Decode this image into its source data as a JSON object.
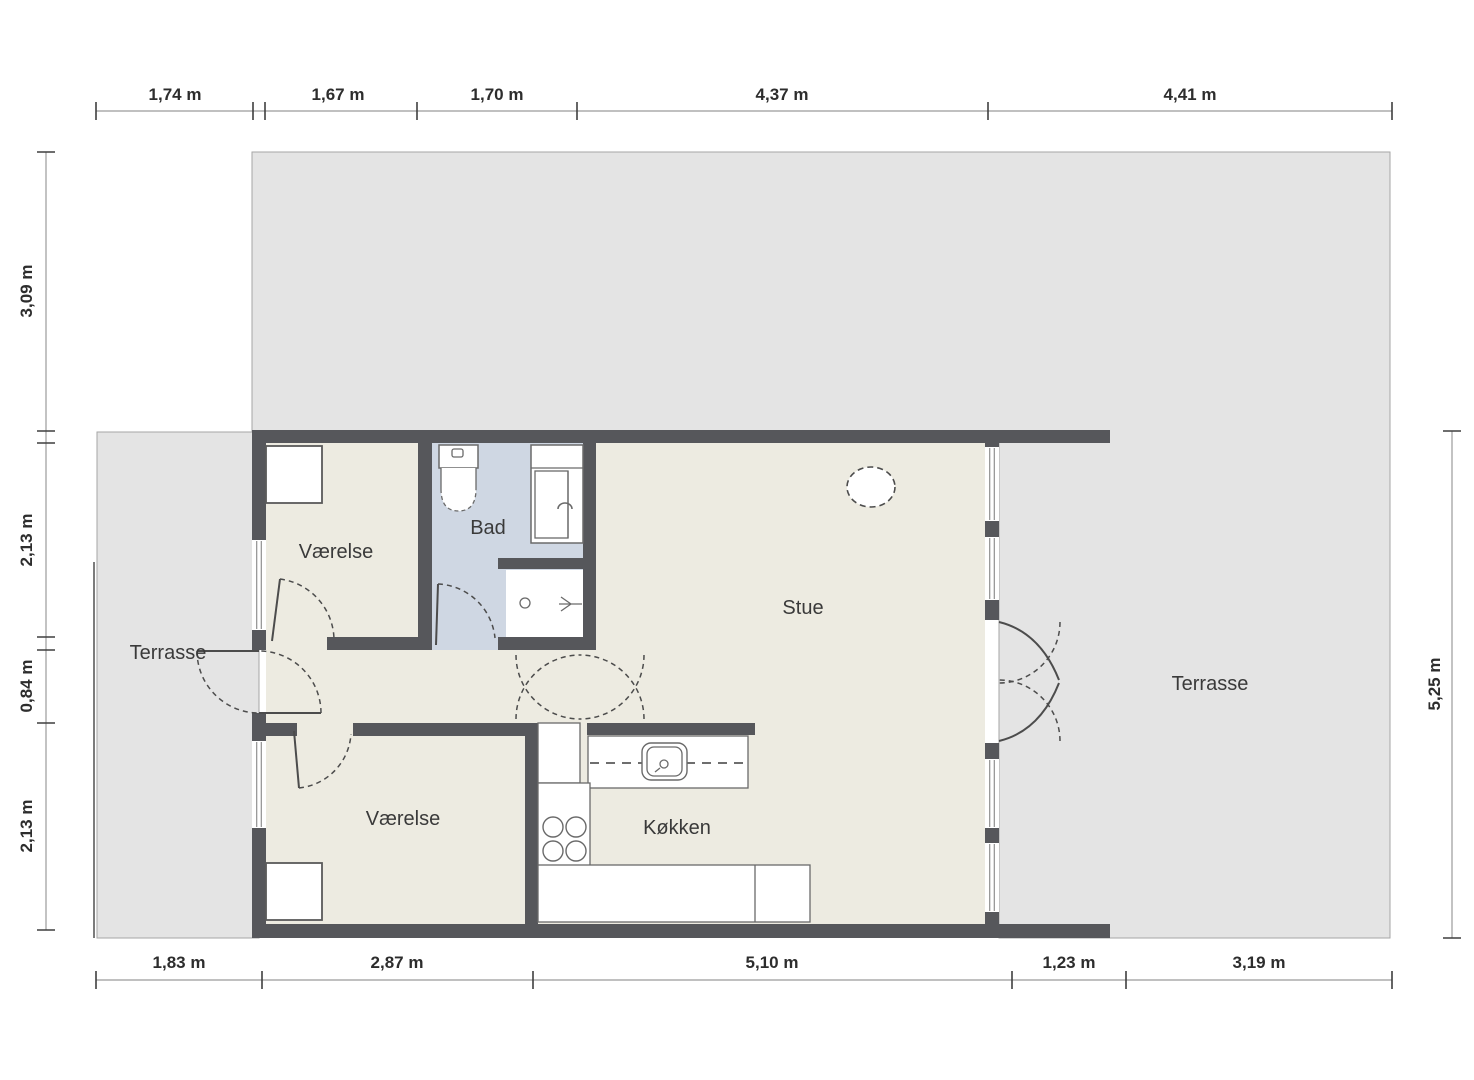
{
  "plan": {
    "rooms": {
      "terrasse_left": "Terrasse",
      "vaerelse_top": "Værelse",
      "bad": "Bad",
      "stue": "Stue",
      "vaerelse_bottom": "Værelse",
      "koekken": "Køkken",
      "terrasse_right": "Terrasse"
    },
    "dimensions": {
      "top": [
        "1,74 m",
        "1,67 m",
        "1,70 m",
        "4,37 m",
        "4,41 m"
      ],
      "bottom": [
        "1,83 m",
        "2,87 m",
        "5,10 m",
        "1,23 m",
        "3,19 m"
      ],
      "left": [
        "3,09 m",
        "2,13 m",
        "0,84 m",
        "2,13 m"
      ],
      "right": [
        "5,25 m"
      ]
    },
    "colors": {
      "wall": "#56575b",
      "floor": "#edebe1",
      "bath_floor": "#cfd7e3",
      "terrace": "#e4e4e4",
      "outline": "#a6a6a6",
      "fixture_stroke": "#6a6a6a",
      "door_stroke": "#4c4c4c",
      "dim_line": "#9b9b9b",
      "dim_text": "#2d2d2d",
      "label_text": "#3a3a3a"
    }
  }
}
